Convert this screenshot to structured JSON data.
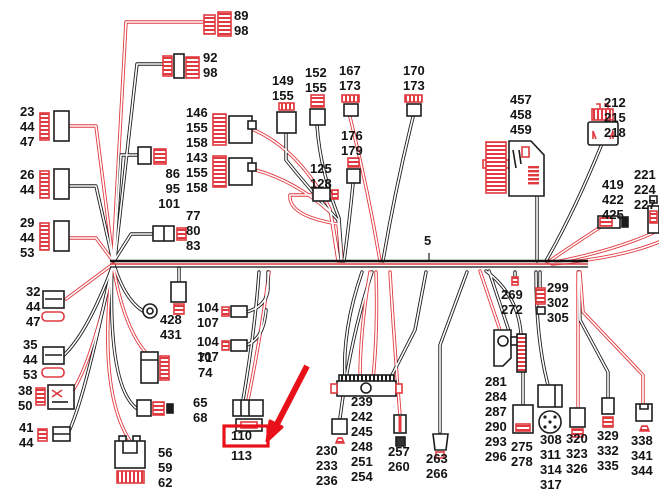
{
  "diagram": {
    "kind": "wiring-harness-overview",
    "main_harness_label": "5",
    "colors": {
      "wire_black": "#1d1d1d",
      "wire_red": "#e03a40",
      "highlight_red": "#e8111a",
      "background": "#ffffff",
      "label_text": "#141414"
    },
    "highlight": {
      "target_label": "110",
      "marker": "red-box-and-red-arrow"
    },
    "labels": [
      {
        "id": "89-98",
        "text": "89\n98",
        "x": 234,
        "y": 8
      },
      {
        "id": "92-98",
        "text": "92\n98",
        "x": 203,
        "y": 50
      },
      {
        "id": "23-44-47",
        "text": "23\n44\n47",
        "x": 20,
        "y": 104
      },
      {
        "id": "26-44",
        "text": "26\n44",
        "x": 20,
        "y": 167
      },
      {
        "id": "29-44-53",
        "text": "29\n44\n53",
        "x": 20,
        "y": 215
      },
      {
        "id": "32-44-47",
        "text": "32\n44\n47",
        "x": 26,
        "y": 284
      },
      {
        "id": "35-44-53",
        "text": "35\n44\n53",
        "x": 23,
        "y": 337
      },
      {
        "id": "38-50",
        "text": "38\n50",
        "x": 18,
        "y": 383
      },
      {
        "id": "41-44",
        "text": "41\n44",
        "x": 19,
        "y": 420
      },
      {
        "id": "86-95-101",
        "text": "86\n95\n101",
        "x": 180,
        "y": 166,
        "align": "right"
      },
      {
        "id": "77-80-83",
        "text": "77\n80\n83",
        "x": 186,
        "y": 208
      },
      {
        "id": "428-431",
        "text": "428\n431",
        "x": 160,
        "y": 312
      },
      {
        "id": "71-74",
        "text": "71\n74",
        "x": 198,
        "y": 350
      },
      {
        "id": "65-68",
        "text": "65\n68",
        "x": 193,
        "y": 395
      },
      {
        "id": "56-59-62",
        "text": "56\n59\n62",
        "x": 158,
        "y": 445
      },
      {
        "id": "146-155-158",
        "text": "146\n155\n158",
        "x": 186,
        "y": 105
      },
      {
        "id": "143-155-158",
        "text": "143\n155\n158",
        "x": 186,
        "y": 150
      },
      {
        "id": "149-155",
        "text": "149\n155",
        "x": 272,
        "y": 73
      },
      {
        "id": "152-155",
        "text": "152\n155",
        "x": 305,
        "y": 65
      },
      {
        "id": "167-173",
        "text": "167\n173",
        "x": 339,
        "y": 63
      },
      {
        "id": "170-173",
        "text": "170\n173",
        "x": 403,
        "y": 63
      },
      {
        "id": "176-179",
        "text": "176\n179",
        "x": 341,
        "y": 128
      },
      {
        "id": "125-128",
        "text": "125\n128",
        "x": 310,
        "y": 161
      },
      {
        "id": "main-5",
        "text": "5",
        "x": 424,
        "y": 233
      },
      {
        "id": "104-107-upper",
        "text": "104\n107",
        "x": 197,
        "y": 300
      },
      {
        "id": "104-107-lower",
        "text": "104\n107",
        "x": 197,
        "y": 334
      },
      {
        "id": "110",
        "text": "110",
        "x": 231,
        "y": 428
      },
      {
        "id": "113",
        "text": "113",
        "x": 231,
        "y": 448
      },
      {
        "id": "230-233-236",
        "text": "230\n233\n236",
        "x": 316,
        "y": 443
      },
      {
        "id": "239-242-245-248-251-254",
        "text": "239\n242\n245\n248\n251\n254",
        "x": 351,
        "y": 394
      },
      {
        "id": "257-260",
        "text": "257\n260",
        "x": 388,
        "y": 444
      },
      {
        "id": "263-266",
        "text": "263\n266",
        "x": 426,
        "y": 451
      },
      {
        "id": "269-272",
        "text": "269\n272",
        "x": 501,
        "y": 287
      },
      {
        "id": "299-302-305",
        "text": "299\n302\n305",
        "x": 547,
        "y": 280
      },
      {
        "id": "281-284-287-290-293-296",
        "text": "281\n284\n287\n290\n293\n296",
        "x": 485,
        "y": 374
      },
      {
        "id": "275-278",
        "text": "275\n278",
        "x": 511,
        "y": 439
      },
      {
        "id": "308-311-314-317",
        "text": "308\n311\n314\n317",
        "x": 540,
        "y": 432
      },
      {
        "id": "320-323-326",
        "text": "320\n323\n326",
        "x": 566,
        "y": 431
      },
      {
        "id": "329-332-335",
        "text": "329\n332\n335",
        "x": 597,
        "y": 428
      },
      {
        "id": "338-341-344",
        "text": "338\n341\n344",
        "x": 631,
        "y": 433
      },
      {
        "id": "457-458-459",
        "text": "457\n458\n459",
        "x": 510,
        "y": 92
      },
      {
        "id": "212-215-218",
        "text": "212\n215\n218",
        "x": 604,
        "y": 95
      },
      {
        "id": "419-422-425",
        "text": "419\n422\n425",
        "x": 602,
        "y": 177
      },
      {
        "id": "221-224-227",
        "text": "221\n224\n227",
        "x": 634,
        "y": 167
      }
    ]
  }
}
